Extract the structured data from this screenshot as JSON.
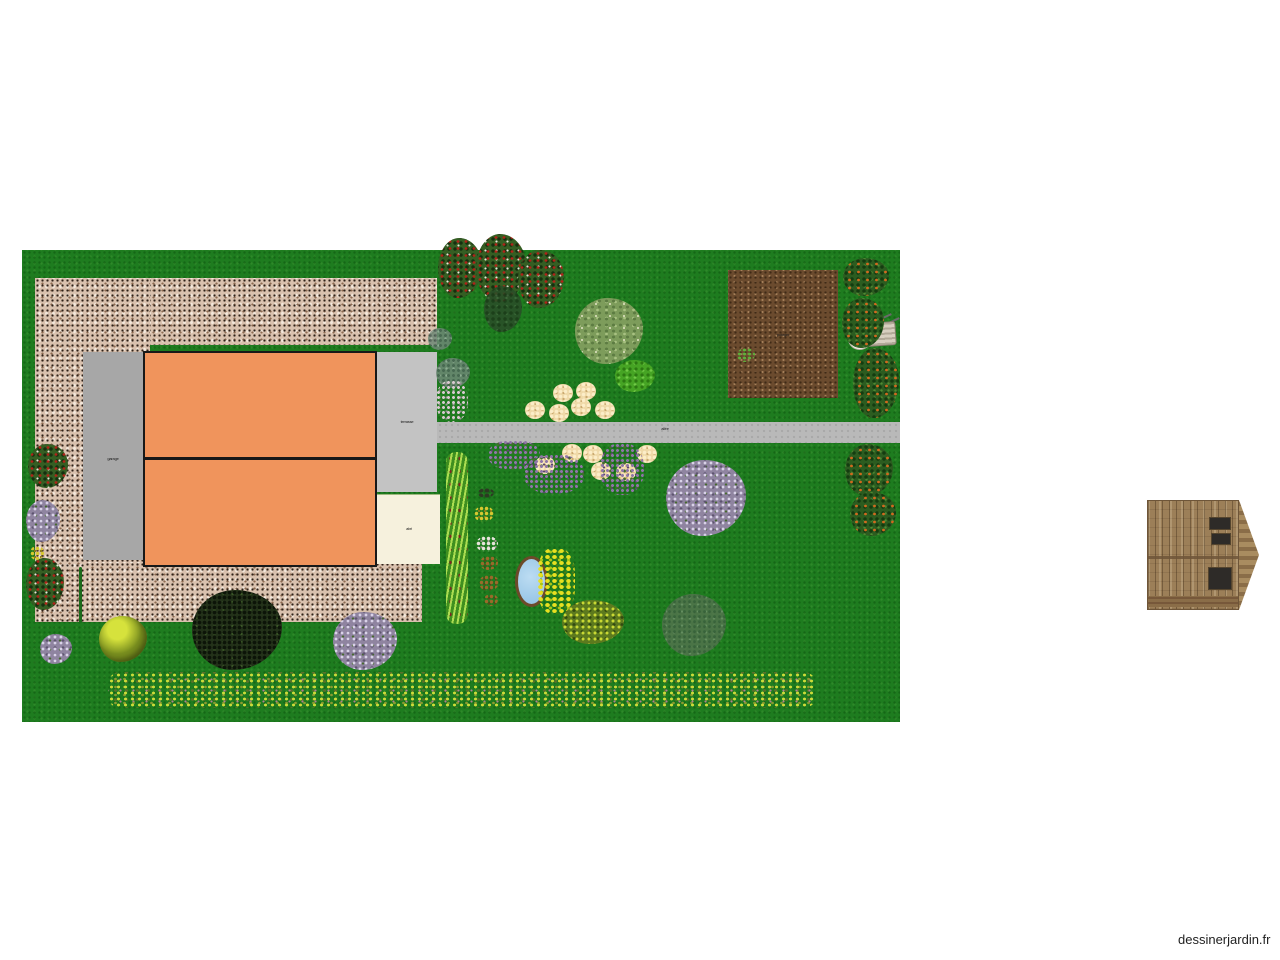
{
  "page": {
    "background": "#ffffff",
    "watermark": "dessinerjardin.fr",
    "canvas_width": 1280,
    "canvas_height": 960
  },
  "colors": {
    "lawn_green": "#1e7c1f",
    "gravel_beige": "#d9c1ae",
    "house_orange": "#f0945c",
    "garage_gray": "#a7a7a7",
    "terrace_gray": "#c3c3c3",
    "garden_shed_cream": "#f6f1dd",
    "path_gray": "#b9b9b9",
    "soil_brown": "#6b4b2e",
    "pond_blue": "#9cc7e6",
    "shed_wood_brown": "#9c7f58"
  },
  "garden": {
    "labels": [
      {
        "name": "garage-area-label",
        "text": "garage",
        "x": 98,
        "y": 457
      },
      {
        "name": "terrasse-area-label",
        "text": "terrasse",
        "x": 392,
        "y": 420
      },
      {
        "name": "abri-area-label",
        "text": "abri",
        "x": 394,
        "y": 527
      },
      {
        "name": "allee-path-label",
        "text": "allée",
        "x": 650,
        "y": 427
      },
      {
        "name": "potager-area-label",
        "text": "potager",
        "x": 768,
        "y": 333
      }
    ],
    "plants": [
      {
        "type": "rosebush",
        "name": "rose-bush",
        "x": 438,
        "y": 238,
        "w": 44,
        "h": 60
      },
      {
        "type": "rosebush",
        "name": "rose-bush",
        "x": 476,
        "y": 234,
        "w": 50,
        "h": 68
      },
      {
        "type": "rosebush",
        "name": "rose-bush",
        "x": 518,
        "y": 250,
        "w": 46,
        "h": 58
      },
      {
        "type": "rosebush",
        "name": "rose-bush",
        "x": 28,
        "y": 444,
        "w": 40,
        "h": 44
      },
      {
        "type": "rosebush",
        "name": "rose-bush",
        "x": 26,
        "y": 558,
        "w": 38,
        "h": 52
      },
      {
        "type": "darkoval",
        "name": "dark-shrub",
        "x": 484,
        "y": 286,
        "w": 38,
        "h": 46
      },
      {
        "type": "lighttree",
        "name": "large-tree",
        "x": 575,
        "y": 298,
        "w": 68,
        "h": 66
      },
      {
        "type": "brighttree",
        "name": "small-tree",
        "x": 615,
        "y": 360,
        "w": 40,
        "h": 32
      },
      {
        "type": "bluegray",
        "name": "gray-green-shrub",
        "x": 428,
        "y": 328,
        "w": 24,
        "h": 22
      },
      {
        "type": "bluegray",
        "name": "gray-green-shrub",
        "x": 436,
        "y": 358,
        "w": 34,
        "h": 30
      },
      {
        "type": "fruitbush",
        "name": "fruit-bush",
        "x": 843,
        "y": 258,
        "w": 46,
        "h": 38
      },
      {
        "type": "fruitbush",
        "name": "fruit-bush",
        "x": 842,
        "y": 298,
        "w": 42,
        "h": 50
      },
      {
        "type": "fruitbush",
        "name": "fruit-bush",
        "x": 853,
        "y": 348,
        "w": 46,
        "h": 70
      },
      {
        "type": "fruitbush",
        "name": "fruit-bush",
        "x": 845,
        "y": 444,
        "w": 48,
        "h": 52
      },
      {
        "type": "fruitbush",
        "name": "fruit-bush",
        "x": 850,
        "y": 492,
        "w": 46,
        "h": 44
      },
      {
        "type": "lilac",
        "name": "lilac-bush",
        "x": 666,
        "y": 460,
        "w": 80,
        "h": 76
      },
      {
        "type": "lilac",
        "name": "lilac-bush",
        "x": 333,
        "y": 612,
        "w": 64,
        "h": 58
      },
      {
        "type": "lilac",
        "name": "lilac-bush",
        "x": 26,
        "y": 500,
        "w": 34,
        "h": 42
      },
      {
        "type": "lilac",
        "name": "lilac-bush",
        "x": 40,
        "y": 634,
        "w": 32,
        "h": 30
      },
      {
        "type": "graybush",
        "name": "faded-shrub",
        "x": 662,
        "y": 594,
        "w": 64,
        "h": 62
      },
      {
        "type": "darkbush",
        "name": "dark-bush",
        "x": 192,
        "y": 590,
        "w": 90,
        "h": 80
      },
      {
        "type": "yellowball",
        "name": "boxwood-ball",
        "x": 99,
        "y": 616,
        "w": 48,
        "h": 46
      },
      {
        "type": "olivebush",
        "name": "olive-bush",
        "x": 562,
        "y": 600,
        "w": 62,
        "h": 44
      },
      {
        "type": "grasshedge",
        "name": "climbing-hedge",
        "x": 446,
        "y": 452,
        "w": 22,
        "h": 172
      },
      {
        "type": "pinkcluster",
        "name": "flower-cluster",
        "x": 436,
        "y": 380,
        "w": 32,
        "h": 42
      },
      {
        "type": "creamflower",
        "name": "cream-flower",
        "x": 553,
        "y": 384,
        "w": 20,
        "h": 18
      },
      {
        "type": "creamflower",
        "name": "cream-flower",
        "x": 576,
        "y": 382,
        "w": 20,
        "h": 18
      },
      {
        "type": "creamflower",
        "name": "cream-flower",
        "x": 525,
        "y": 401,
        "w": 20,
        "h": 18
      },
      {
        "type": "creamflower",
        "name": "cream-flower",
        "x": 549,
        "y": 404,
        "w": 20,
        "h": 18
      },
      {
        "type": "creamflower",
        "name": "cream-flower",
        "x": 571,
        "y": 398,
        "w": 20,
        "h": 18
      },
      {
        "type": "creamflower",
        "name": "cream-flower",
        "x": 595,
        "y": 401,
        "w": 20,
        "h": 18
      },
      {
        "type": "creamflower",
        "name": "cream-flower",
        "x": 562,
        "y": 444,
        "w": 20,
        "h": 18
      },
      {
        "type": "creamflower",
        "name": "cream-flower",
        "x": 583,
        "y": 445,
        "w": 20,
        "h": 18
      },
      {
        "type": "creamflower",
        "name": "cream-flower",
        "x": 535,
        "y": 456,
        "w": 20,
        "h": 18
      },
      {
        "type": "creamflower",
        "name": "cream-flower",
        "x": 591,
        "y": 462,
        "w": 20,
        "h": 18
      },
      {
        "type": "creamflower",
        "name": "cream-flower",
        "x": 637,
        "y": 445,
        "w": 20,
        "h": 18
      },
      {
        "type": "creamflower",
        "name": "cream-flower",
        "x": 616,
        "y": 463,
        "w": 20,
        "h": 18
      },
      {
        "type": "purplepatch",
        "name": "purple-flower-patch",
        "x": 488,
        "y": 440,
        "w": 52,
        "h": 30
      },
      {
        "type": "purplepatch",
        "name": "purple-flower-patch",
        "x": 524,
        "y": 454,
        "w": 60,
        "h": 40
      },
      {
        "type": "purplepatch",
        "name": "purple-flower-patch",
        "x": 600,
        "y": 443,
        "w": 44,
        "h": 52
      },
      {
        "type": "iris",
        "name": "yellow-iris",
        "x": 537,
        "y": 548,
        "w": 38,
        "h": 66
      },
      {
        "type": "flowerstrip",
        "name": "flower-meadow-strip",
        "x": 108,
        "y": 672,
        "w": 708,
        "h": 36
      },
      {
        "type": "sprite-dark",
        "name": "small-plant",
        "x": 478,
        "y": 488,
        "w": 16,
        "h": 10
      },
      {
        "type": "sprite-yellow",
        "name": "small-plant",
        "x": 474,
        "y": 506,
        "w": 20,
        "h": 16
      },
      {
        "type": "sprite-white",
        "name": "small-plant",
        "x": 476,
        "y": 536,
        "w": 22,
        "h": 16
      },
      {
        "type": "sprite-brown",
        "name": "small-plant",
        "x": 480,
        "y": 556,
        "w": 18,
        "h": 14
      },
      {
        "type": "sprite-brown",
        "name": "small-plant",
        "x": 479,
        "y": 575,
        "w": 20,
        "h": 16
      },
      {
        "type": "sprite-brown",
        "name": "small-plant",
        "x": 484,
        "y": 594,
        "w": 14,
        "h": 12
      },
      {
        "type": "sprite-yellow",
        "name": "small-plant",
        "x": 30,
        "y": 546,
        "w": 14,
        "h": 14
      },
      {
        "type": "sprite-green",
        "name": "seedling",
        "x": 737,
        "y": 348,
        "w": 18,
        "h": 14
      },
      {
        "type": "hedge-line",
        "name": "hedge-line",
        "x": 79,
        "y": 567,
        "w": 3,
        "h": 56
      }
    ]
  }
}
